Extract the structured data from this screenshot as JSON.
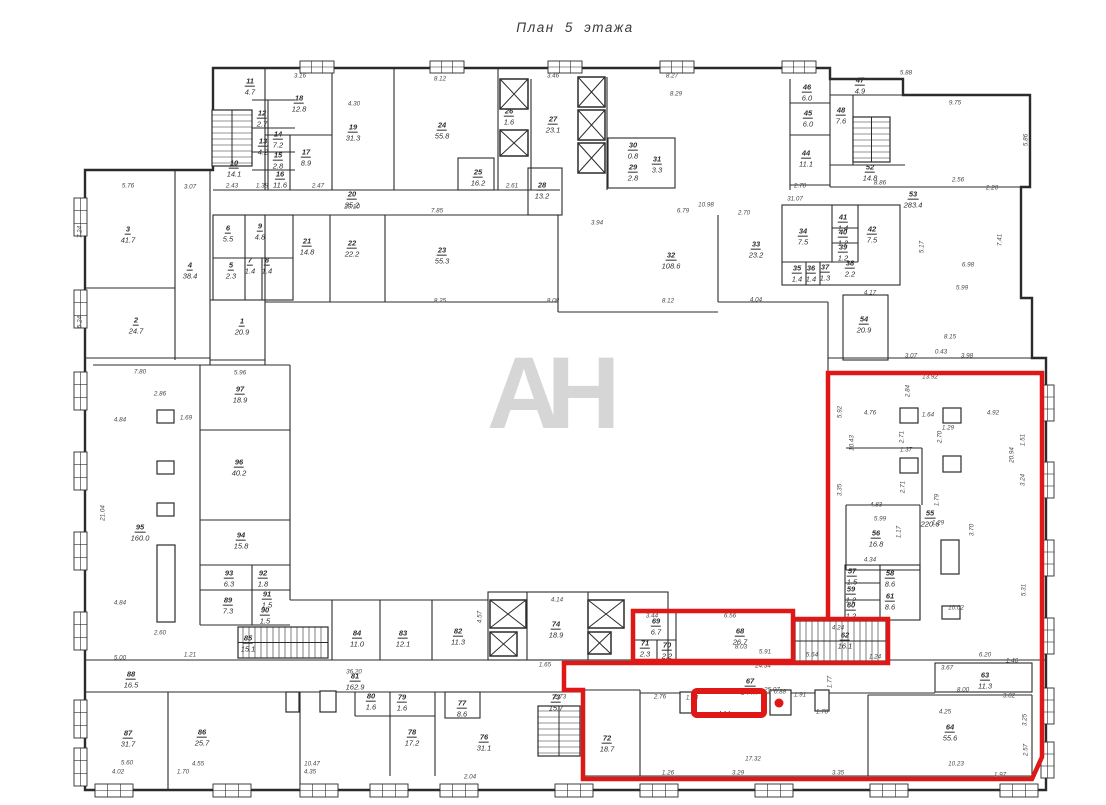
{
  "title": "План 5 этажа",
  "watermark": "АН",
  "highlight": {
    "color": "#e01717",
    "main_path": "M828,619 L828,373 L1042,373 L1042,757 L1032,779 L583,779 L583,690 L564,690 L564,663 L888,663 L888,619 L793,619",
    "rooms_path": "M633,611 L793,611 L793,661 L633,661 Z",
    "small_rect": {
      "x": 694,
      "y": 691,
      "w": 70,
      "h": 24
    },
    "dot": {
      "x": 779,
      "y": 703,
      "r": 4.5
    }
  },
  "rooms": [
    {
      "n": "1",
      "a": "20.9",
      "x": 242,
      "y": 324
    },
    {
      "n": "2",
      "a": "24.7",
      "x": 136,
      "y": 323
    },
    {
      "n": "3",
      "a": "41.7",
      "x": 128,
      "y": 232
    },
    {
      "n": "4",
      "a": "38.4",
      "x": 190,
      "y": 268
    },
    {
      "n": "5",
      "a": "2.3",
      "x": 231,
      "y": 268
    },
    {
      "n": "6",
      "a": "5.5",
      "x": 228,
      "y": 231
    },
    {
      "n": "7",
      "a": "1.4",
      "x": 250,
      "y": 263
    },
    {
      "n": "8",
      "a": "1.4",
      "x": 267,
      "y": 263
    },
    {
      "n": "9",
      "a": "4.8",
      "x": 260,
      "y": 229
    },
    {
      "n": "10",
      "a": "14.1",
      "x": 234,
      "y": 166
    },
    {
      "n": "11",
      "a": "4.7",
      "x": 250,
      "y": 84
    },
    {
      "n": "12",
      "a": "2.7",
      "x": 262,
      "y": 116
    },
    {
      "n": "13",
      "a": "4.2",
      "x": 263,
      "y": 144
    },
    {
      "n": "14",
      "a": "7.2",
      "x": 278,
      "y": 137
    },
    {
      "n": "15",
      "a": "2.8",
      "x": 278,
      "y": 158
    },
    {
      "n": "16",
      "a": "11.6",
      "x": 280,
      "y": 177
    },
    {
      "n": "17",
      "a": "8.9",
      "x": 306,
      "y": 155
    },
    {
      "n": "18",
      "a": "12.8",
      "x": 299,
      "y": 101
    },
    {
      "n": "19",
      "a": "31.3",
      "x": 353,
      "y": 130
    },
    {
      "n": "20",
      "a": "35.2",
      "x": 352,
      "y": 197
    },
    {
      "n": "21",
      "a": "14.8",
      "x": 307,
      "y": 244
    },
    {
      "n": "22",
      "a": "22.2",
      "x": 352,
      "y": 246
    },
    {
      "n": "23",
      "a": "55.3",
      "x": 442,
      "y": 253
    },
    {
      "n": "24",
      "a": "55.8",
      "x": 442,
      "y": 128
    },
    {
      "n": "25",
      "a": "16.2",
      "x": 478,
      "y": 175
    },
    {
      "n": "26",
      "a": "1.6",
      "x": 509,
      "y": 114
    },
    {
      "n": "27",
      "a": "23.1",
      "x": 553,
      "y": 122
    },
    {
      "n": "28",
      "a": "13.2",
      "x": 542,
      "y": 188
    },
    {
      "n": "29",
      "a": "2.8",
      "x": 633,
      "y": 170
    },
    {
      "n": "30",
      "a": "0.8",
      "x": 633,
      "y": 148
    },
    {
      "n": "31",
      "a": "3.3",
      "x": 657,
      "y": 162
    },
    {
      "n": "32",
      "a": "108.6",
      "x": 671,
      "y": 258
    },
    {
      "n": "33",
      "a": "23.2",
      "x": 756,
      "y": 247
    },
    {
      "n": "34",
      "a": "7.5",
      "x": 803,
      "y": 234
    },
    {
      "n": "35",
      "a": "1.4",
      "x": 797,
      "y": 271
    },
    {
      "n": "36",
      "a": "1.4",
      "x": 811,
      "y": 271
    },
    {
      "n": "37",
      "a": "1.3",
      "x": 825,
      "y": 270
    },
    {
      "n": "38",
      "a": "2.2",
      "x": 850,
      "y": 266
    },
    {
      "n": "39",
      "a": "1.2",
      "x": 843,
      "y": 250
    },
    {
      "n": "40",
      "a": "1.2",
      "x": 843,
      "y": 235
    },
    {
      "n": "41",
      "a": "1.4",
      "x": 843,
      "y": 220
    },
    {
      "n": "42",
      "a": "7.5",
      "x": 872,
      "y": 232
    },
    {
      "n": "44",
      "a": "11.1",
      "x": 806,
      "y": 156
    },
    {
      "n": "45",
      "a": "6.0",
      "x": 808,
      "y": 116
    },
    {
      "n": "46",
      "a": "6.0",
      "x": 807,
      "y": 90
    },
    {
      "n": "47",
      "a": "4.9",
      "x": 860,
      "y": 83
    },
    {
      "n": "48",
      "a": "7.6",
      "x": 841,
      "y": 113
    },
    {
      "n": "52",
      "a": "14.8",
      "x": 870,
      "y": 170
    },
    {
      "n": "53",
      "a": "283.4",
      "x": 913,
      "y": 197
    },
    {
      "n": "54",
      "a": "20.9",
      "x": 864,
      "y": 322
    },
    {
      "n": "55",
      "a": "220.6",
      "x": 930,
      "y": 516
    },
    {
      "n": "56",
      "a": "16.8",
      "x": 876,
      "y": 536
    },
    {
      "n": "57",
      "a": "1.5",
      "x": 852,
      "y": 574
    },
    {
      "n": "58",
      "a": "8.6",
      "x": 890,
      "y": 576
    },
    {
      "n": "59",
      "a": "1.2",
      "x": 851,
      "y": 592
    },
    {
      "n": "60",
      "a": "1.2",
      "x": 851,
      "y": 608
    },
    {
      "n": "61",
      "a": "8.6",
      "x": 890,
      "y": 599
    },
    {
      "n": "62",
      "a": "16.1",
      "x": 845,
      "y": 638
    },
    {
      "n": "63",
      "a": "11.3",
      "x": 985,
      "y": 678
    },
    {
      "n": "64",
      "a": "55.6",
      "x": 950,
      "y": 730
    },
    {
      "n": "67",
      "a": "144.7",
      "x": 750,
      "y": 684
    },
    {
      "n": "68",
      "a": "26.7",
      "x": 740,
      "y": 634
    },
    {
      "n": "69",
      "a": "6.7",
      "x": 656,
      "y": 624
    },
    {
      "n": "70",
      "a": "2.2",
      "x": 667,
      "y": 648
    },
    {
      "n": "71",
      "a": "2.3",
      "x": 645,
      "y": 646
    },
    {
      "n": "72",
      "a": "18.7",
      "x": 607,
      "y": 741
    },
    {
      "n": "73",
      "a": "15.7",
      "x": 556,
      "y": 700
    },
    {
      "n": "74",
      "a": "18.9",
      "x": 556,
      "y": 627
    },
    {
      "n": "76",
      "a": "31.1",
      "x": 484,
      "y": 740
    },
    {
      "n": "77",
      "a": "8.6",
      "x": 462,
      "y": 706
    },
    {
      "n": "78",
      "a": "17.2",
      "x": 412,
      "y": 735
    },
    {
      "n": "79",
      "a": "1.6",
      "x": 402,
      "y": 700
    },
    {
      "n": "80",
      "a": "1.6",
      "x": 371,
      "y": 699
    },
    {
      "n": "81",
      "a": "162.9",
      "x": 355,
      "y": 679
    },
    {
      "n": "82",
      "a": "11.3",
      "x": 458,
      "y": 634
    },
    {
      "n": "83",
      "a": "12.1",
      "x": 403,
      "y": 636
    },
    {
      "n": "84",
      "a": "11.0",
      "x": 357,
      "y": 636
    },
    {
      "n": "85",
      "a": "15.1",
      "x": 248,
      "y": 641
    },
    {
      "n": "86",
      "a": "25.7",
      "x": 202,
      "y": 735
    },
    {
      "n": "87",
      "a": "31.7",
      "x": 128,
      "y": 736
    },
    {
      "n": "88",
      "a": "16.5",
      "x": 131,
      "y": 677
    },
    {
      "n": "89",
      "a": "7.3",
      "x": 228,
      "y": 603
    },
    {
      "n": "90",
      "a": "1.5",
      "x": 265,
      "y": 613
    },
    {
      "n": "91",
      "a": "1.5",
      "x": 267,
      "y": 597
    },
    {
      "n": "92",
      "a": "1.8",
      "x": 263,
      "y": 576
    },
    {
      "n": "93",
      "a": "6.3",
      "x": 229,
      "y": 576
    },
    {
      "n": "94",
      "a": "15.8",
      "x": 241,
      "y": 538
    },
    {
      "n": "95",
      "a": "160.0",
      "x": 140,
      "y": 530
    },
    {
      "n": "96",
      "a": "40.2",
      "x": 239,
      "y": 465
    },
    {
      "n": "97",
      "a": "18.9",
      "x": 240,
      "y": 392
    }
  ],
  "dimensions": [
    {
      "t": "5.76",
      "x": 128,
      "y": 186
    },
    {
      "t": "3.07",
      "x": 190,
      "y": 187
    },
    {
      "t": "3.16",
      "x": 300,
      "y": 76
    },
    {
      "t": "4.30",
      "x": 354,
      "y": 104
    },
    {
      "t": "8.12",
      "x": 440,
      "y": 79
    },
    {
      "t": "3.46",
      "x": 553,
      "y": 76
    },
    {
      "t": "8.27",
      "x": 672,
      "y": 76
    },
    {
      "t": "8.29",
      "x": 676,
      "y": 94
    },
    {
      "t": "5.88",
      "x": 906,
      "y": 73
    },
    {
      "t": "9.75",
      "x": 955,
      "y": 103
    },
    {
      "t": "2.43",
      "x": 232,
      "y": 186
    },
    {
      "t": "1.38",
      "x": 262,
      "y": 186
    },
    {
      "t": "2.47",
      "x": 318,
      "y": 186
    },
    {
      "t": "2.61",
      "x": 512,
      "y": 186
    },
    {
      "t": "2.78",
      "x": 800,
      "y": 186
    },
    {
      "t": "8.86",
      "x": 880,
      "y": 183
    },
    {
      "t": "31.07",
      "x": 795,
      "y": 199
    },
    {
      "t": "2.56",
      "x": 958,
      "y": 180
    },
    {
      "t": "2.20",
      "x": 992,
      "y": 188
    },
    {
      "t": "5.86",
      "x": 1026,
      "y": 140,
      "r": 1
    },
    {
      "t": "7.41",
      "x": 1000,
      "y": 240,
      "r": 1
    },
    {
      "t": "5.17",
      "x": 922,
      "y": 247,
      "r": 1
    },
    {
      "t": "6.98",
      "x": 968,
      "y": 265
    },
    {
      "t": "5.99",
      "x": 962,
      "y": 288
    },
    {
      "t": "8.15",
      "x": 950,
      "y": 337
    },
    {
      "t": "3.07",
      "x": 911,
      "y": 356
    },
    {
      "t": "0.43",
      "x": 941,
      "y": 352
    },
    {
      "t": "3.98",
      "x": 967,
      "y": 356
    },
    {
      "t": "20.10",
      "x": 352,
      "y": 207
    },
    {
      "t": "3.94",
      "x": 597,
      "y": 223
    },
    {
      "t": "7.85",
      "x": 437,
      "y": 211
    },
    {
      "t": "6.79",
      "x": 683,
      "y": 211
    },
    {
      "t": "10.98",
      "x": 706,
      "y": 205
    },
    {
      "t": "2.70",
      "x": 744,
      "y": 213
    },
    {
      "t": "8.25",
      "x": 440,
      "y": 301
    },
    {
      "t": "8.08",
      "x": 553,
      "y": 301
    },
    {
      "t": "8.12",
      "x": 668,
      "y": 301
    },
    {
      "t": "4.04",
      "x": 756,
      "y": 300
    },
    {
      "t": "4.17",
      "x": 870,
      "y": 293
    },
    {
      "t": "7.80",
      "x": 140,
      "y": 372
    },
    {
      "t": "5.96",
      "x": 240,
      "y": 373
    },
    {
      "t": "21.04",
      "x": 103,
      "y": 513,
      "r": 1
    },
    {
      "t": "2.86",
      "x": 160,
      "y": 394
    },
    {
      "t": "1.69",
      "x": 186,
      "y": 418
    },
    {
      "t": "4.84",
      "x": 120,
      "y": 420
    },
    {
      "t": "4.84",
      "x": 120,
      "y": 603
    },
    {
      "t": "2.60",
      "x": 160,
      "y": 633
    },
    {
      "t": "5.00",
      "x": 120,
      "y": 658
    },
    {
      "t": "1.21",
      "x": 190,
      "y": 655
    },
    {
      "t": "7.24",
      "x": 80,
      "y": 232,
      "r": 1
    },
    {
      "t": "5.24",
      "x": 80,
      "y": 322,
      "r": 1
    },
    {
      "t": "13.92",
      "x": 930,
      "y": 377
    },
    {
      "t": "2.84",
      "x": 908,
      "y": 391,
      "r": 1
    },
    {
      "t": "4.76",
      "x": 870,
      "y": 413
    },
    {
      "t": "1.64",
      "x": 928,
      "y": 415
    },
    {
      "t": "4.92",
      "x": 993,
      "y": 413
    },
    {
      "t": "5.92",
      "x": 840,
      "y": 412,
      "r": 1
    },
    {
      "t": "10.43",
      "x": 852,
      "y": 443,
      "r": 1
    },
    {
      "t": "3.35",
      "x": 840,
      "y": 490,
      "r": 1
    },
    {
      "t": "20.94",
      "x": 1012,
      "y": 455,
      "r": 1
    },
    {
      "t": "1.51",
      "x": 1023,
      "y": 440,
      "r": 1
    },
    {
      "t": "3.24",
      "x": 1023,
      "y": 480,
      "r": 1
    },
    {
      "t": "2.71",
      "x": 902,
      "y": 437,
      "r": 1
    },
    {
      "t": "2.70",
      "x": 940,
      "y": 437,
      "r": 1
    },
    {
      "t": "1.29",
      "x": 948,
      "y": 428
    },
    {
      "t": "1.37",
      "x": 906,
      "y": 450
    },
    {
      "t": "2.71",
      "x": 903,
      "y": 487,
      "r": 1
    },
    {
      "t": "4.83",
      "x": 876,
      "y": 505
    },
    {
      "t": "5.99",
      "x": 880,
      "y": 519
    },
    {
      "t": "4.34",
      "x": 870,
      "y": 560
    },
    {
      "t": "1.17",
      "x": 899,
      "y": 532,
      "r": 1
    },
    {
      "t": "1.29",
      "x": 938,
      "y": 523
    },
    {
      "t": "1.79",
      "x": 937,
      "y": 500,
      "r": 1
    },
    {
      "t": "3.70",
      "x": 972,
      "y": 530,
      "r": 1
    },
    {
      "t": "5.31",
      "x": 1024,
      "y": 590,
      "r": 1
    },
    {
      "t": "10.02",
      "x": 956,
      "y": 608
    },
    {
      "t": "36.20",
      "x": 354,
      "y": 672
    },
    {
      "t": "24.34",
      "x": 763,
      "y": 666
    },
    {
      "t": "25.07",
      "x": 772,
      "y": 690
    },
    {
      "t": "6.20",
      "x": 985,
      "y": 655
    },
    {
      "t": "1.46",
      "x": 1012,
      "y": 661
    },
    {
      "t": "3.67",
      "x": 947,
      "y": 668
    },
    {
      "t": "8.00",
      "x": 963,
      "y": 690
    },
    {
      "t": "3.02",
      "x": 1009,
      "y": 696
    },
    {
      "t": "4.25",
      "x": 945,
      "y": 712
    },
    {
      "t": "3.25",
      "x": 1025,
      "y": 720,
      "r": 1
    },
    {
      "t": "2.57",
      "x": 1026,
      "y": 750,
      "r": 1
    },
    {
      "t": "17.32",
      "x": 753,
      "y": 759
    },
    {
      "t": "10.23",
      "x": 956,
      "y": 764
    },
    {
      "t": "1.97",
      "x": 1000,
      "y": 775
    },
    {
      "t": "3.35",
      "x": 838,
      "y": 773
    },
    {
      "t": "3.29",
      "x": 738,
      "y": 773
    },
    {
      "t": "1.26",
      "x": 668,
      "y": 773
    },
    {
      "t": "10.47",
      "x": 312,
      "y": 764
    },
    {
      "t": "5.60",
      "x": 127,
      "y": 763
    },
    {
      "t": "4.02",
      "x": 118,
      "y": 772
    },
    {
      "t": "1.70",
      "x": 183,
      "y": 772
    },
    {
      "t": "4.55",
      "x": 198,
      "y": 764
    },
    {
      "t": "4.35",
      "x": 310,
      "y": 772
    },
    {
      "t": "2.04",
      "x": 470,
      "y": 777
    },
    {
      "t": "6.56",
      "x": 730,
      "y": 616
    },
    {
      "t": "3.44",
      "x": 652,
      "y": 616
    },
    {
      "t": "8.03",
      "x": 741,
      "y": 647
    },
    {
      "t": "5.91",
      "x": 765,
      "y": 652
    },
    {
      "t": "1.14",
      "x": 692,
      "y": 698
    },
    {
      "t": "2.76",
      "x": 660,
      "y": 697
    },
    {
      "t": "0.88",
      "x": 780,
      "y": 692
    },
    {
      "t": "1.91",
      "x": 800,
      "y": 695
    },
    {
      "t": "1.78",
      "x": 822,
      "y": 712
    },
    {
      "t": "1.77",
      "x": 830,
      "y": 682,
      "r": 1
    },
    {
      "t": "4.14",
      "x": 724,
      "y": 714
    },
    {
      "t": "2.73",
      "x": 560,
      "y": 697
    },
    {
      "t": "1.65",
      "x": 545,
      "y": 665
    },
    {
      "t": "4.57",
      "x": 480,
      "y": 617,
      "r": 1
    },
    {
      "t": "4.14",
      "x": 557,
      "y": 600
    },
    {
      "t": "4.24",
      "x": 838,
      "y": 628
    },
    {
      "t": "1.24",
      "x": 875,
      "y": 657
    },
    {
      "t": "5.64",
      "x": 812,
      "y": 655
    }
  ]
}
